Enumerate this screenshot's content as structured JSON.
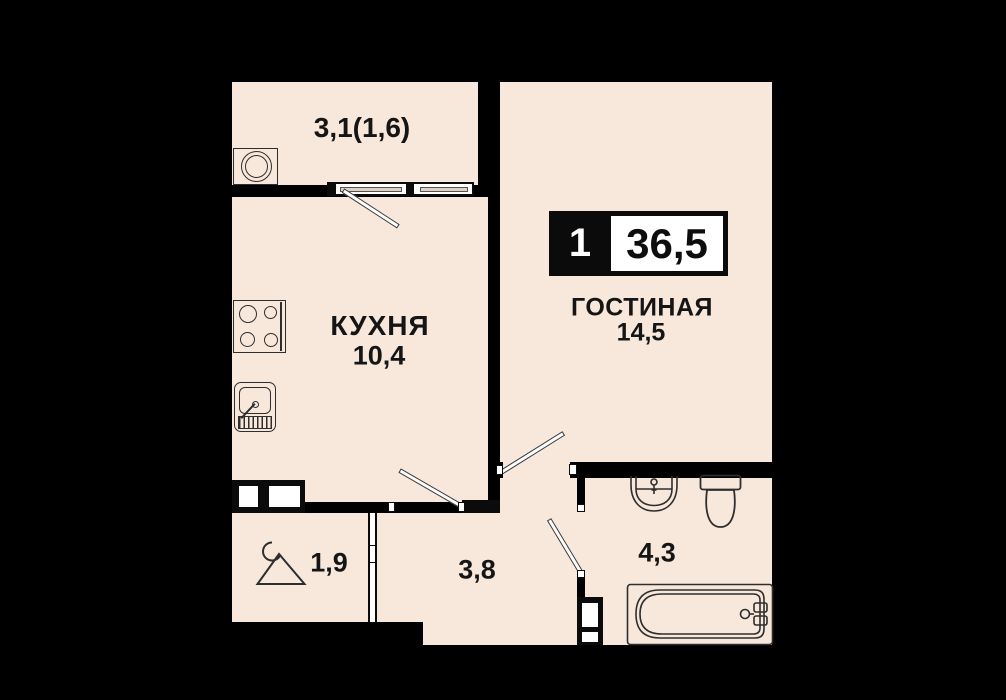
{
  "badge": {
    "rooms_count": "1",
    "total_area": "36,5"
  },
  "rooms": {
    "balcony": {
      "area_label": "3,1(1,6)"
    },
    "kitchen": {
      "name": "КУХНЯ",
      "area": "10,4"
    },
    "living": {
      "name": "ГОСТИНАЯ",
      "area": "14,5"
    },
    "wardrobe": {
      "area": "1,9"
    },
    "hallway": {
      "area": "3,8"
    },
    "bathroom": {
      "area": "4,3"
    }
  },
  "icons": [
    "washing-machine-icon",
    "stove-icon",
    "kitchen-sink-icon",
    "hanger-icon",
    "washbasin-icon",
    "toilet-icon",
    "bathtub-icon",
    "vent-shaft-icon",
    "window-icon",
    "door-leaf-icon",
    "sliding-door-icon"
  ],
  "colors": {
    "background": "#000000",
    "floor": "#f8e8dc",
    "wall": "#0b0b0b",
    "outline": "#2e2e2e",
    "glass": "#d9d2ca",
    "text": "#151515",
    "white": "#ffffff"
  }
}
